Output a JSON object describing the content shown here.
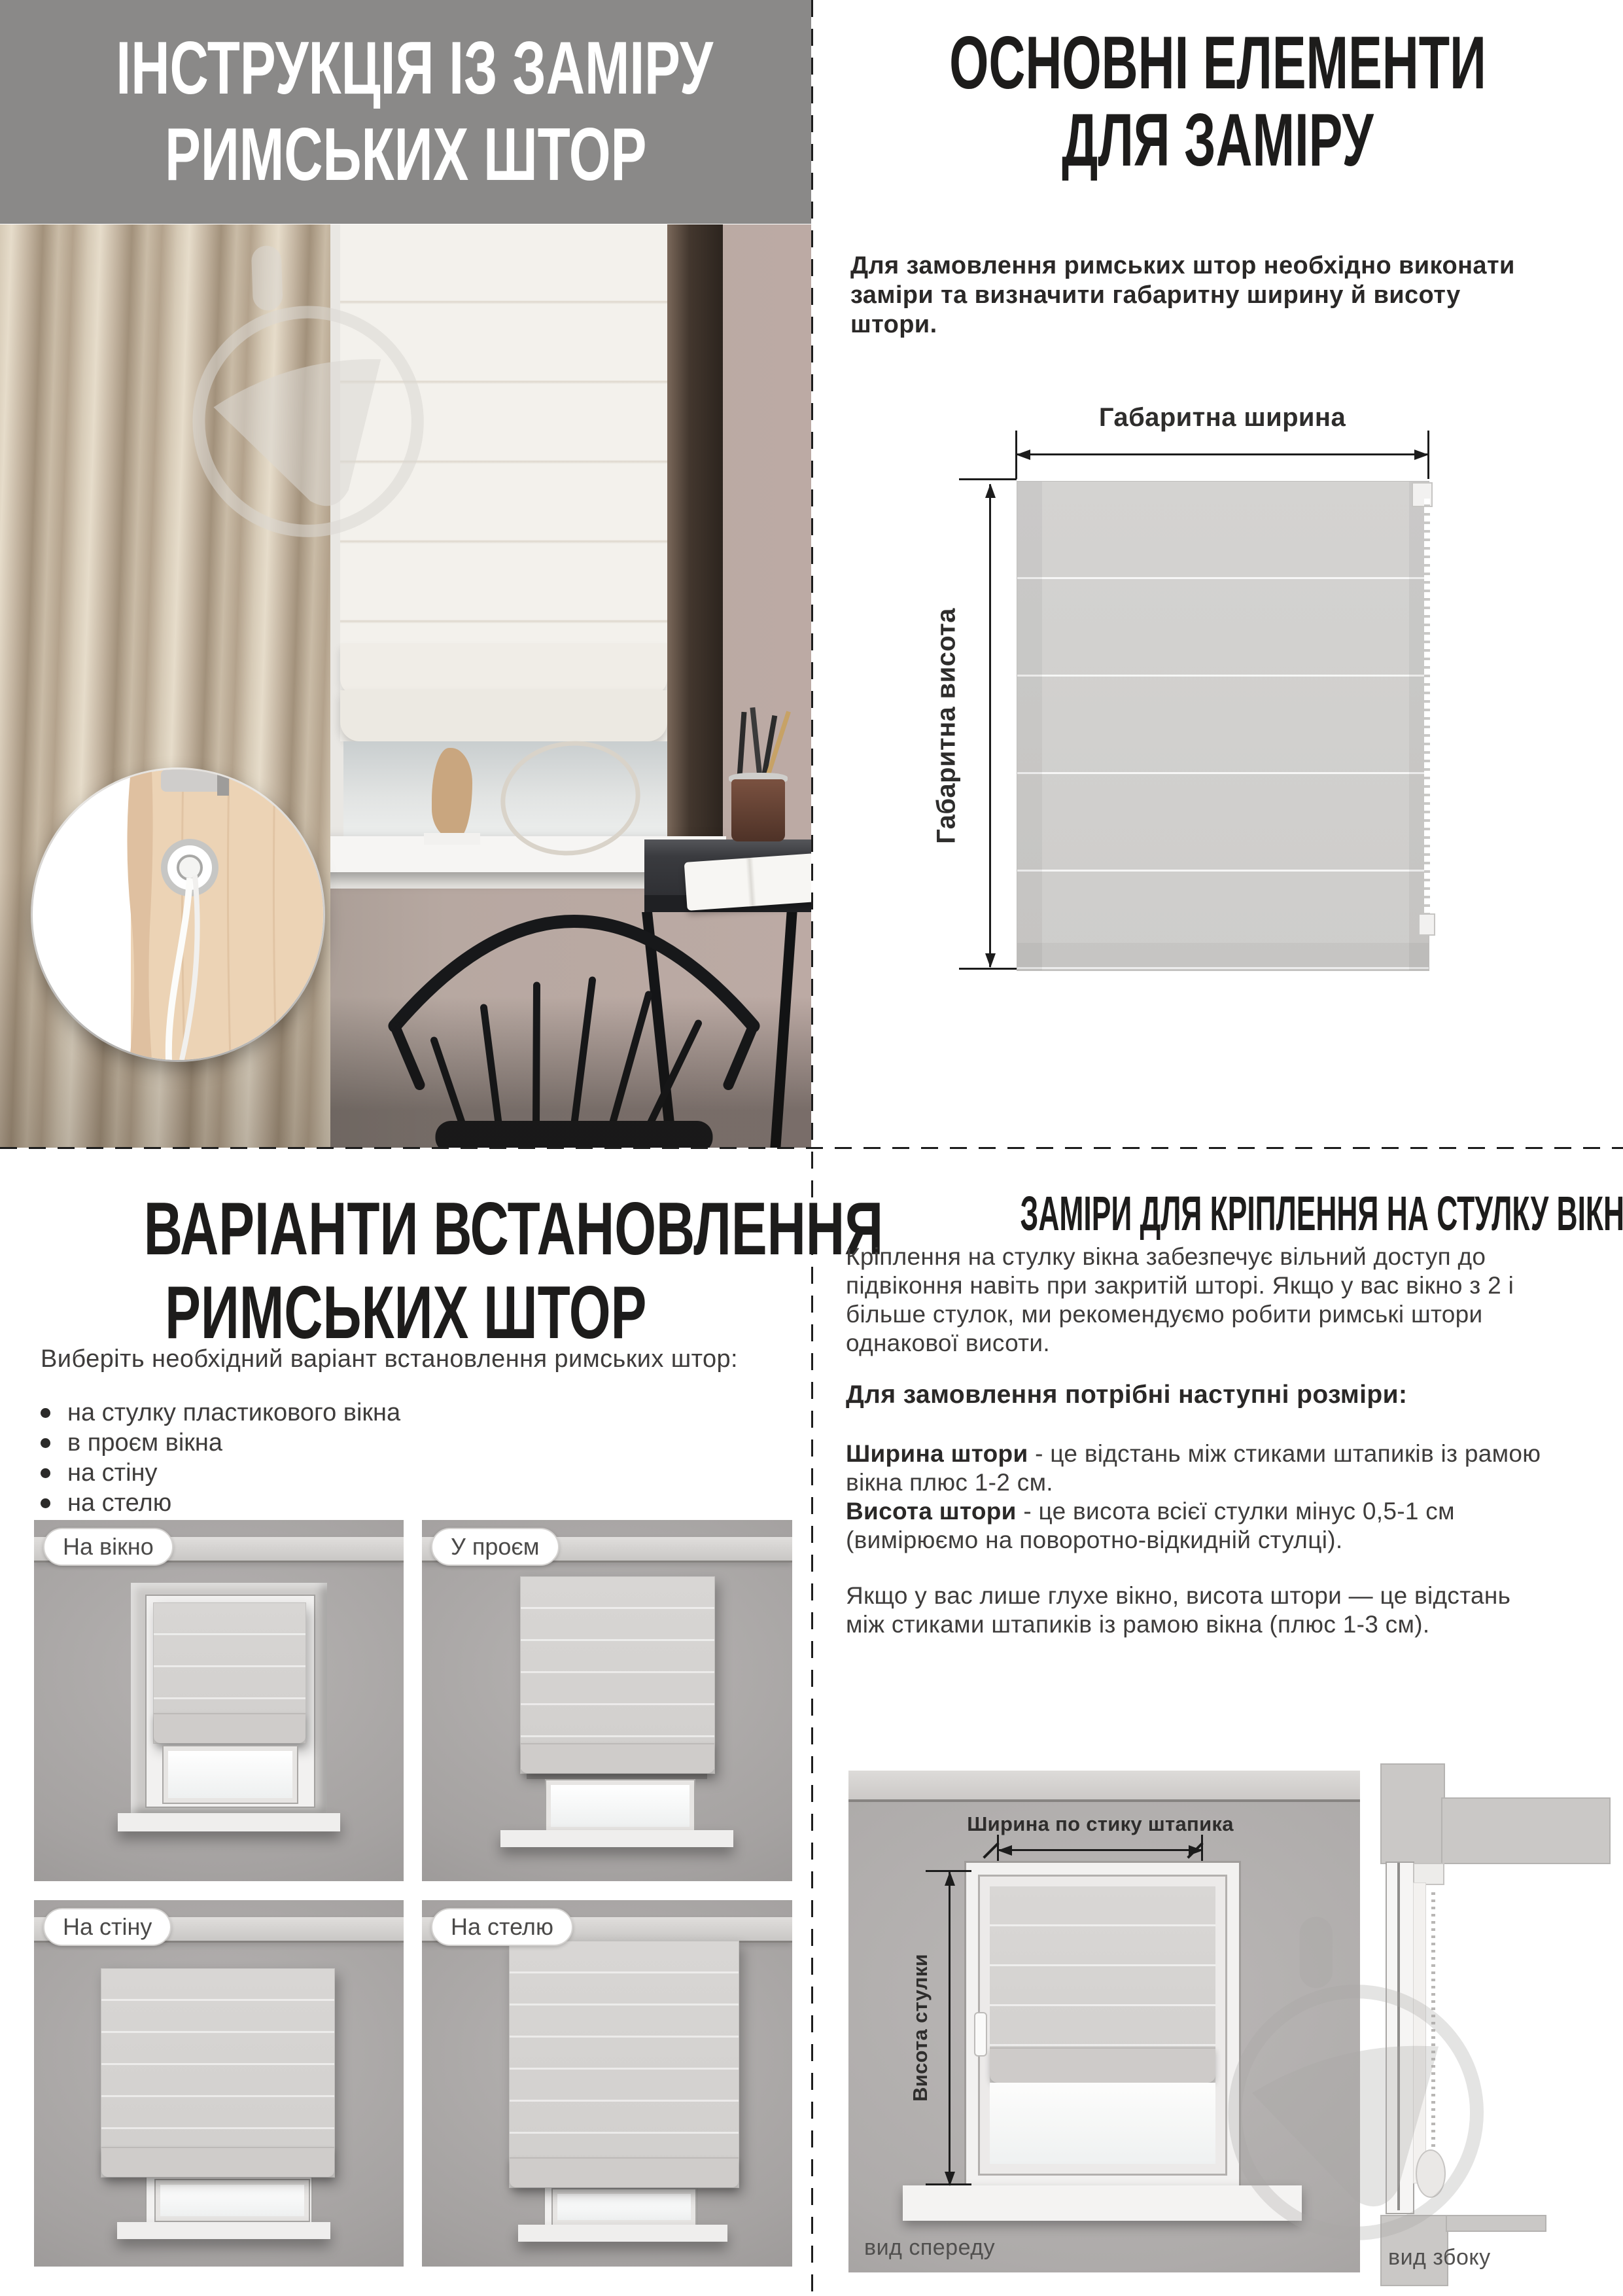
{
  "header": {
    "title_line1": "ІНСТРУКЦІЯ  ІЗ  ЗАМІРУ",
    "title_line2": "РИМСЬКИХ ШТОР"
  },
  "main_elements": {
    "title_line1": "ОСНОВНІ ЕЛЕМЕНТИ",
    "title_line2": "ДЛЯ ЗАМІРУ",
    "intro_lines": [
      "Для замовлення римських штор необхідно виконати",
      "заміри та визначити габаритну ширину й висоту",
      "штори."
    ],
    "diagram": {
      "width_label": "Габаритна ширина",
      "height_label": "Габаритна висота"
    }
  },
  "install": {
    "title_line1": "ВАРІАНТИ ВСТАНОВЛЕННЯ",
    "title_line2": "РИМСЬКИХ ШТОР",
    "intro": "Виберіть необхідний варіант встановлення римських штор:",
    "bullets": [
      "на стулку пластикового вікна",
      "в проєм вікна",
      "на стіну",
      "на стелю"
    ],
    "tiles": [
      {
        "label": "На вікно"
      },
      {
        "label": "У проєм"
      },
      {
        "label": "На стіну"
      },
      {
        "label": "На стелю"
      }
    ]
  },
  "sash": {
    "title": "ЗАМІРИ ДЛЯ КРІПЛЕННЯ НА СТУЛКУ ВІКНА",
    "p1_lines": [
      "Кріплення на стулку вікна забезпечує вільний доступ до",
      "підвіконня навіть при закритій шторі. Якщо у вас вікно з 2 і",
      "більше стулок, ми рекомендуємо робити римські штори",
      "однакової висоти."
    ],
    "sizes_heading": "Для замовлення потрібні наступні розміри:",
    "width_term": "Ширина штори",
    "width_rest": " - це відстань між стиками штапиків із рамою",
    "width_line2": "вікна плюс 1-2 см.",
    "height_term": "Висота штори",
    "height_rest": " - це висота всієї стулки мінус 0,5-1 см",
    "height_line2": "(вимірюємо на поворотно-відкидній стулці).",
    "p2_lines": [
      "Якщо у вас лише глухе вікно, висота штори — це відстань",
      "між стиками штапиків із рамою вікна (плюс 1-3 см)."
    ],
    "front": {
      "width_label": "Ширина по стику штапика",
      "height_label": "Висота стулки",
      "caption": "вид спереду"
    },
    "side": {
      "caption": "вид збоку"
    }
  }
}
